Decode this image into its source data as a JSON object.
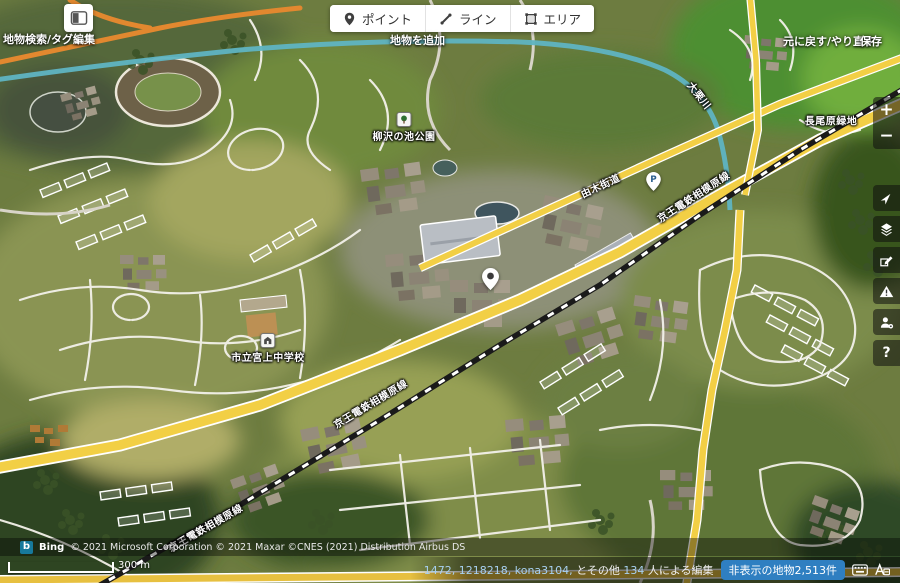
{
  "header": {
    "sidebar_caption": "地物検索/タグ編集",
    "add_feature_caption": "地物を追加",
    "undo_redo_caption": "元に戻す/やり直す",
    "save_caption": "保存",
    "tools": [
      {
        "label": "ポイント",
        "icon": "point-pin-icon"
      },
      {
        "label": "ライン",
        "icon": "line-pen-icon"
      },
      {
        "label": "エリア",
        "icon": "area-square-icon"
      }
    ]
  },
  "map_controls": {
    "zoom_in": "+",
    "zoom_out": "−",
    "help_glyph": "?",
    "icons": [
      "geolocate-arrow-icon",
      "layers-icon",
      "map-data-icon",
      "issues-warning-icon",
      "user-settings-icon",
      "help-icon"
    ]
  },
  "map_labels": {
    "park": "柳沢の池公園",
    "green_space": "長尾原緑地",
    "school": "市立宮上中学校",
    "railway": "京王電鉄相模原線",
    "road": "由木街道",
    "river": "大栗川",
    "parking_marker": "P"
  },
  "status_bar": {
    "provider_logo": "b",
    "provider": "Bing",
    "attribution": "© 2021 Microsoft Corporation © 2021 Maxar ©CNES (2021) Distribution Airbus DS",
    "scale_label": "300 m",
    "editors": {
      "user1": "1472,",
      "user2": "1218218,",
      "user3": "kona3104,",
      "others_prefix": "とその他",
      "others_count": "134",
      "others_suffix": "人による編集"
    },
    "hidden_features_badge": "非表示の地物2,513件"
  },
  "colors": {
    "badge_blue": "#2f7fc1",
    "link_blue": "#a8d0f0",
    "road_yellow": "#f2cf45",
    "river_teal": "#5fb4c2",
    "control_bg": "rgba(15,15,15,0.55)"
  }
}
